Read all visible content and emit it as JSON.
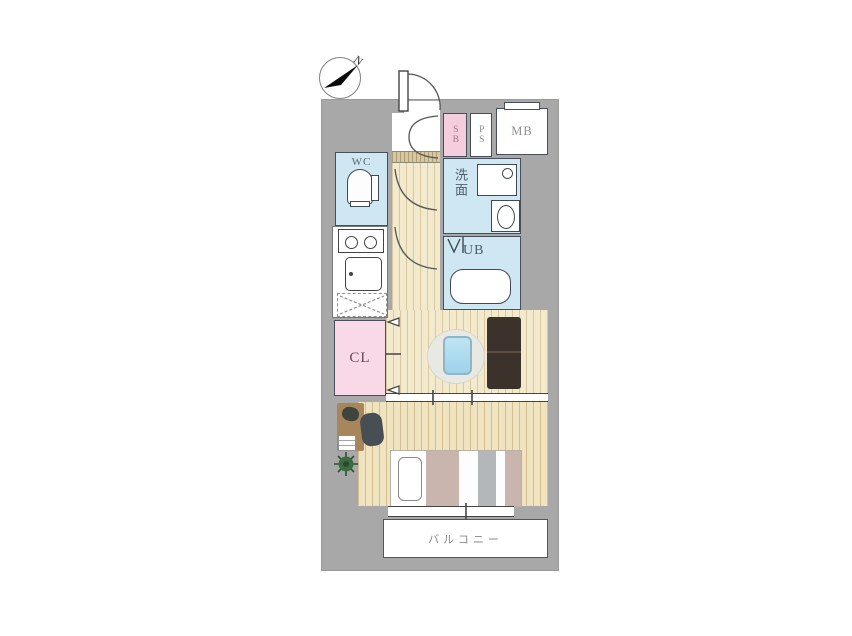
{
  "plan": {
    "type": "apartment-floor-plan",
    "compass": {
      "north_label": "N"
    },
    "rooms": {
      "wc": {
        "label": "WC"
      },
      "washroom": {
        "label": "洗面"
      },
      "unit_bath": {
        "label": "UB"
      },
      "closet": {
        "label": "CL"
      },
      "shoe_box": {
        "label": "SB"
      },
      "pipe_shaft": {
        "label": "PS"
      },
      "meter_box": {
        "label": "MB"
      },
      "balcony": {
        "label": "バルコニー"
      }
    },
    "palette": {
      "wall_gray": "#a8a8a8",
      "wet_area_blue": "#cfe7f2",
      "closet_pink": "#f9d9e8",
      "shoe_box_pink": "#f5cedd",
      "wood_floor": "#f3e9cc",
      "entry_floor": "#d7c69e",
      "laptop_blue": "#a9dcf2",
      "sofa_brown": "#3a322b",
      "bed_mauve": "#c9b4ae",
      "plant_green": "#3c6b40"
    }
  }
}
